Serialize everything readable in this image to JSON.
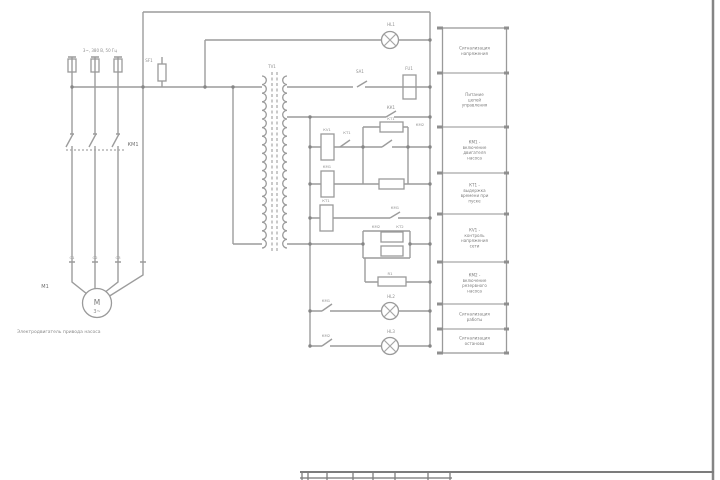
{
  "page": {
    "background": "#ffffff",
    "line_color": "#9c9c9c",
    "text_color": "#8f8f8f",
    "dark_text_color": "#6f6f6f",
    "sheet_border_color": "#858585"
  },
  "power": {
    "supply_label": "3~, 380 В, 50 Гц",
    "breaker_label": "SF1",
    "contactor_label": "КМ1",
    "terminal_labels": {
      "t1": "С1",
      "t2": "С2",
      "t3": "С3"
    },
    "motor_ref": "М1",
    "motor_letter": "М",
    "motor_phase": "3~",
    "caption": "Электродвигатель привода насоса"
  },
  "control": {
    "transformer_label": "ТV1",
    "lamp_top": "HL1",
    "switch_sa1": "SA1",
    "fuse_fu1": "FU1",
    "contact_kk1": "КК1",
    "coil_kv1": "КV1",
    "contact_kt1": "КТ1",
    "block1_top": "КТ1",
    "block1_side": "КМ2",
    "coil_km1": "КМ1",
    "coil_kt1": "КТ1",
    "contact_km1": "КМ1",
    "block2_a": "КМ2",
    "block2_b": "КТ2",
    "resistor_r1": "R1",
    "contact_km1_b": "КМ1",
    "lamp_hl2": "HL2",
    "contact_km2": "КМ2",
    "lamp_hl3": "HL3"
  },
  "legend": {
    "rows": [
      {
        "label": "Сигнализация напряжения"
      },
      {
        "label": "Питание цепей управления"
      },
      {
        "label": "КМ1 - включение двигателя насоса"
      },
      {
        "label": "КТ1 - выдержка времени при пуске"
      },
      {
        "label": "КV1 - контроль напряжения сети"
      },
      {
        "label": "КМ2 - включение резервного насоса"
      },
      {
        "label": "Сигнализация работы"
      },
      {
        "label": "Сигнализация останова"
      }
    ]
  }
}
